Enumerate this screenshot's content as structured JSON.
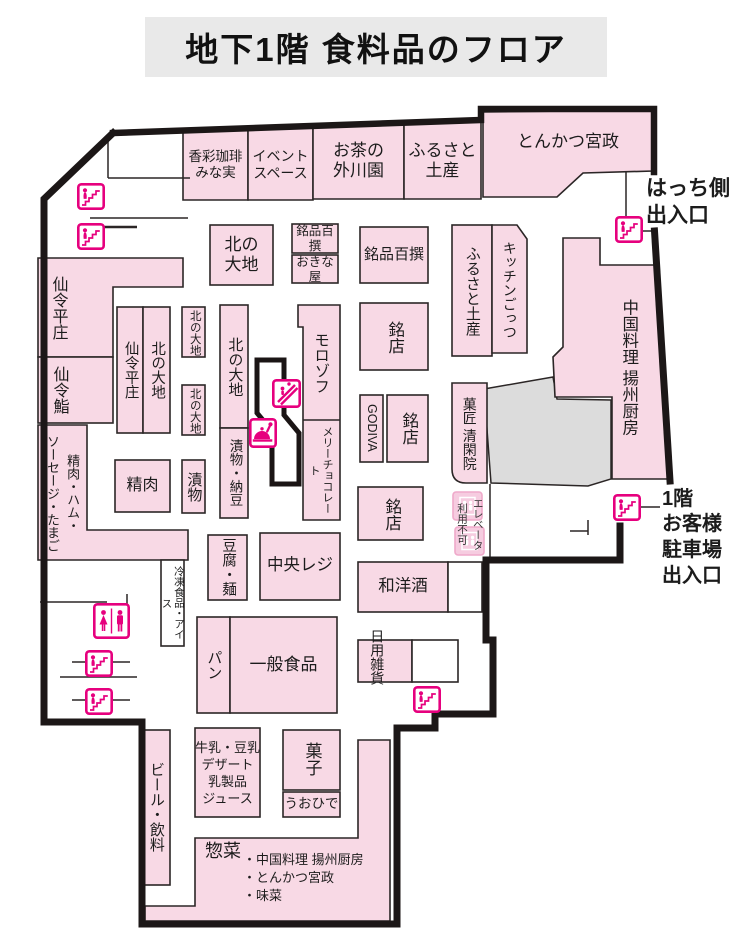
{
  "title": "地下1階 食料品のフロア",
  "entrances": {
    "hatchi": "はっち側\n出入口",
    "parking": "1階\nお客様\n駐車場\n出入口"
  },
  "stores": {
    "kosai_coffee": "香彩珈琲\nみな実",
    "event_space": "イベント\nスペース",
    "ocha_togawaen": "お茶の\n外川園",
    "furusato_miyage_top": "ふるさと\n土産",
    "tonkatsu_miyamasa": "とんかつ宮政",
    "kita_daichi_main": "北の\n大地",
    "meihin_hyakusen_small": "銘品百撰",
    "okinaya": "おきな屋",
    "meihin_hyakusen_wide": "銘品百撰",
    "senrei_heisho_wall": "仙令平庄",
    "senrei_zushi": "仙令鮨",
    "seiniku_ham_sausage": "精肉・ハム・\nソーセージ・たまご",
    "senrei_heisho_inner": "仙令平庄",
    "kita_daichi_inner": "北の大地",
    "kita_daichi_small1": "北の大地",
    "kita_daichi_small2": "北の大地",
    "tsukemono_small": "漬物",
    "seiniku": "精肉",
    "kita_daichi_tall": "北の大地",
    "tsukemono_natto": "漬物・納豆",
    "morozoff": "モロゾフ",
    "mary_chocolate": "メリーチョコレート",
    "meiten1": "銘店",
    "godiva": "GODIVA",
    "meiten2": "銘店",
    "meiten3": "銘店",
    "furusato_miyage_v": "ふるさと土産",
    "kitchen_gottsu": "キッチンごっつ",
    "yoshu_chubo": "中国料理 揚州厨房",
    "kasho_seikanin": "菓匠 清閑院",
    "tofu_men": "豆腐・麺",
    "chuo_reji": "中央レジ",
    "wayoshu": "和洋酒",
    "reito_ice": "冷凍食品・アイス",
    "pan": "パン",
    "ippan_shokuhin": "一般食品",
    "nichiyo_zakka": "日用雑貨",
    "gyunyu_dairy": "牛乳・豆乳\nデザート\n乳製品\nジュース",
    "kashi": "菓子",
    "uohide": "うおひで",
    "beer_inryo": "ビール・飲料",
    "souzai": "惣菜",
    "souzai_items": [
      "・中国料理 揚州厨房",
      "・とんかつ宮政",
      "・味菜"
    ]
  },
  "notes": {
    "elevator_unavailable": "エレベータ\n利用不可"
  },
  "colors": {
    "store_pink": "#f8d9e5",
    "accent_magenta": "#e6007e",
    "wall_black": "#1c1717",
    "gray_area": "#dcdcdc",
    "title_bg": "#e9e9e9"
  }
}
